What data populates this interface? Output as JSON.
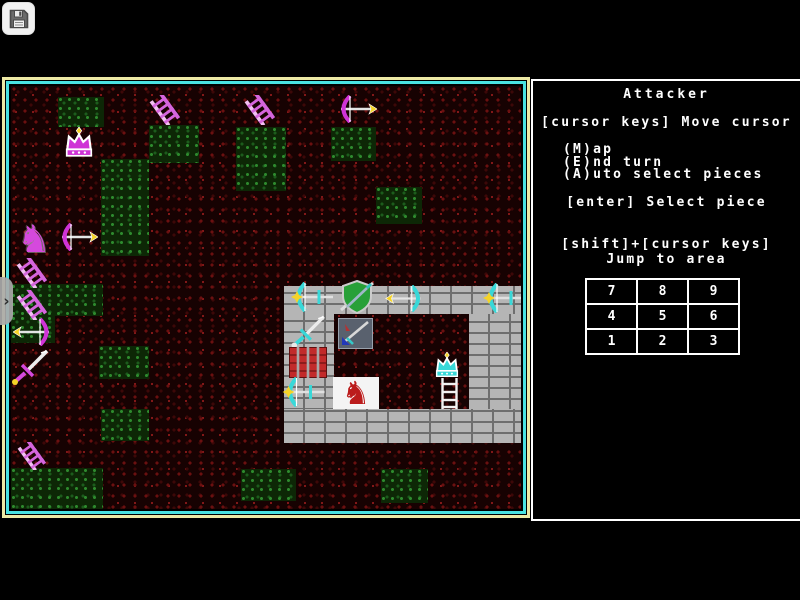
{
  "overlay": {
    "save_icon": "floppy-disk",
    "handle_chevron": "›"
  },
  "sidebar": {
    "title": "Attacker",
    "line_move": "[cursor keys] Move cursor",
    "cmd_map": "(M)ap",
    "cmd_end": "(E)nd turn",
    "cmd_auto": "(A)uto select pieces",
    "line_select": "[enter] Select piece",
    "line_jump1": "[shift]+[cursor keys]",
    "line_jump2": "Jump to area",
    "grid": [
      [
        "7",
        "8",
        "9"
      ],
      [
        "4",
        "5",
        "6"
      ],
      [
        "1",
        "2",
        "3"
      ]
    ]
  },
  "map": {
    "border_outer_color": "#ede9a5",
    "border_inner_color": "#49e2e2",
    "attacker_color": "#cf33d6",
    "defender_color": "#38d8d8",
    "highlight_color": "#f5d327",
    "green_patches": [
      {
        "x": 47,
        "y": 11,
        "w": 46,
        "h": 30
      },
      {
        "x": 138,
        "y": 39,
        "w": 50,
        "h": 38
      },
      {
        "x": 90,
        "y": 73,
        "w": 48,
        "h": 97
      },
      {
        "x": 225,
        "y": 41,
        "w": 50,
        "h": 64
      },
      {
        "x": 320,
        "y": 41,
        "w": 45,
        "h": 34
      },
      {
        "x": 365,
        "y": 101,
        "w": 46,
        "h": 37
      },
      {
        "x": 0,
        "y": 198,
        "w": 92,
        "h": 32
      },
      {
        "x": 0,
        "y": 230,
        "w": 44,
        "h": 27
      },
      {
        "x": 88,
        "y": 260,
        "w": 50,
        "h": 33
      },
      {
        "x": 90,
        "y": 323,
        "w": 48,
        "h": 32
      },
      {
        "x": 0,
        "y": 382,
        "w": 92,
        "h": 42
      },
      {
        "x": 230,
        "y": 383,
        "w": 55,
        "h": 32
      },
      {
        "x": 370,
        "y": 383,
        "w": 47,
        "h": 34
      }
    ],
    "castle_walls": [
      {
        "x": 273,
        "y": 200,
        "w": 239,
        "h": 28
      },
      {
        "x": 273,
        "y": 228,
        "w": 50,
        "h": 127
      },
      {
        "x": 458,
        "y": 228,
        "w": 54,
        "h": 95
      },
      {
        "x": 273,
        "y": 323,
        "w": 239,
        "h": 34
      }
    ],
    "pieces": [
      {
        "type": "crown",
        "name": "attacker-king",
        "x": 48,
        "y": 41,
        "w": 40,
        "h": 32,
        "main": "#cf33d6",
        "accent": "#ffffff",
        "tip": "#f5d327"
      },
      {
        "type": "ladder",
        "name": "attacker-ladder-1",
        "x": 137,
        "y": 9,
        "w": 33,
        "h": 30,
        "main": "#d565dd",
        "accent": "#f2c0f2",
        "tip": "#f5d327"
      },
      {
        "type": "ladder",
        "name": "attacker-ladder-2",
        "x": 232,
        "y": 9,
        "w": 33,
        "h": 30,
        "main": "#d565dd",
        "accent": "#f2c0f2",
        "tip": "#f5d327"
      },
      {
        "type": "bow",
        "name": "attacker-archer-1",
        "x": 326,
        "y": 9,
        "w": 40,
        "h": 28,
        "main": "#cf33d6",
        "accent": "#ffffff",
        "tip": "#f5d327",
        "flip": true
      },
      {
        "type": "horse",
        "name": "attacker-knight",
        "x": 3,
        "y": 134,
        "w": 40,
        "h": 38,
        "main": "#d549dd",
        "accent": "#ffffff",
        "tip": "#f5d327"
      },
      {
        "type": "bow",
        "name": "attacker-archer-2",
        "x": 47,
        "y": 137,
        "w": 40,
        "h": 28,
        "main": "#cf33d6",
        "accent": "#ffffff",
        "tip": "#f5d327",
        "flip": true
      },
      {
        "type": "ladder",
        "name": "attacker-ladder-3",
        "x": 4,
        "y": 172,
        "w": 33,
        "h": 30,
        "main": "#d565dd",
        "accent": "#f2c0f2",
        "tip": "#f5d327"
      },
      {
        "type": "ladder",
        "name": "attacker-ladder-4",
        "x": 4,
        "y": 204,
        "w": 33,
        "h": 30,
        "main": "#d565dd",
        "accent": "#f2c0f2",
        "tip": "#f5d327"
      },
      {
        "type": "bow",
        "name": "attacker-archer-3",
        "x": 2,
        "y": 232,
        "w": 40,
        "h": 28,
        "main": "#cf33d6",
        "accent": "#ffffff",
        "tip": "#f5d327"
      },
      {
        "type": "sword",
        "name": "attacker-sword",
        "x": 0,
        "y": 262,
        "w": 40,
        "h": 38,
        "main": "#d549dd",
        "accent": "#ffffff",
        "tip": "#f5d327"
      },
      {
        "type": "ladder",
        "name": "attacker-ladder-5",
        "x": 4,
        "y": 356,
        "w": 33,
        "h": 28,
        "main": "#d565dd",
        "accent": "#f2c0f2",
        "tip": "#f5d327"
      },
      {
        "type": "crossbow",
        "name": "defender-crossbow-1",
        "x": 279,
        "y": 196,
        "w": 46,
        "h": 30,
        "main": "#38d8d8",
        "accent": "#ffffff",
        "tip": "#f5d327"
      },
      {
        "type": "shield",
        "name": "defender-shield",
        "x": 326,
        "y": 194,
        "w": 40,
        "h": 34,
        "main": "#28a038",
        "accent": "#d8d8d8",
        "tip": "#f5d327"
      },
      {
        "type": "bow",
        "name": "defender-archer",
        "x": 372,
        "y": 199,
        "w": 44,
        "h": 27,
        "main": "#38d8d8",
        "accent": "#ffffff",
        "tip": "#f5d327"
      },
      {
        "type": "crossbow",
        "name": "defender-crossbow-2",
        "x": 472,
        "y": 197,
        "w": 44,
        "h": 30,
        "main": "#38d8d8",
        "accent": "#ffffff",
        "tip": "#f5d327"
      },
      {
        "type": "sword",
        "name": "defender-sword",
        "x": 275,
        "y": 228,
        "w": 46,
        "h": 35,
        "main": "#38d8d8",
        "accent": "#ffffff",
        "tip": "#e8e8e8"
      },
      {
        "type": "panel-shield",
        "name": "selected-piece-panel",
        "x": 327,
        "y": 232,
        "w": 35,
        "h": 31,
        "main": "#59616e",
        "accent": "#99a2ad",
        "tip": "#35c8c8"
      },
      {
        "type": "gate",
        "name": "castle-gate",
        "x": 278,
        "y": 261,
        "w": 38,
        "h": 31,
        "main": "#c22a2a",
        "accent": "#a8a8a8",
        "tip": "#7c1616"
      },
      {
        "type": "crown",
        "name": "defender-king",
        "x": 416,
        "y": 266,
        "w": 40,
        "h": 27,
        "main": "#38d8d8",
        "accent": "#ffffff",
        "tip": "#f5d327"
      },
      {
        "type": "crossbow",
        "name": "defender-crossbow-3",
        "x": 270,
        "y": 291,
        "w": 47,
        "h": 30,
        "main": "#38d8d8",
        "accent": "#ffffff",
        "tip": "#f5d327"
      },
      {
        "type": "panel-horse",
        "name": "cursor-knight-panel",
        "x": 322,
        "y": 291,
        "w": 46,
        "h": 32,
        "main": "#bb1c1c",
        "accent": "#f4f4f4",
        "tip": "#f5d327"
      },
      {
        "type": "ladder-straight",
        "name": "defender-ladder",
        "x": 427,
        "y": 292,
        "w": 23,
        "h": 31,
        "main": "#f2f2f2",
        "accent": "#ffffff",
        "tip": "#f5d327"
      }
    ]
  }
}
